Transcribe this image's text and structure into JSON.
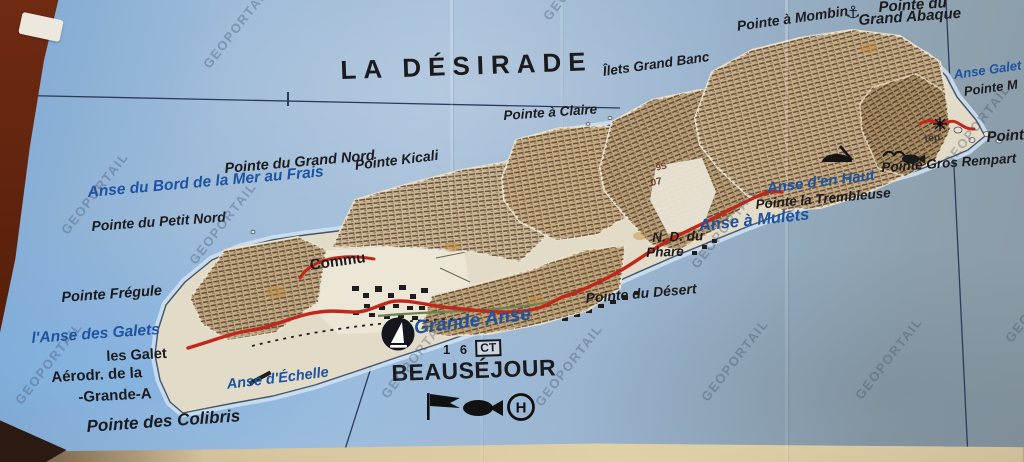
{
  "meta": {
    "kind": "photograph of a paper map with newsprint collage",
    "island": "La Désirade"
  },
  "colors": {
    "sea": "#9db8d4",
    "label_blue": "#1d53a0",
    "label_black": "#1b1b1d",
    "road_red": "#c2271c",
    "track_green": "#6e8352",
    "clipping_tan": "#c6ac85",
    "island_paper": "#e2dbc8",
    "paper_margin": "#d9caa4",
    "photo_border": "#5e2410",
    "watermark": "rgba(62,74,96,0.34)"
  },
  "map": {
    "title": "LA DÉSIRADE",
    "watermark": {
      "text": "GEOPORTAIL"
    },
    "labels": [
      {
        "name": "map-title",
        "text": "LA DÉSIRADE",
        "x": 340,
        "y": 57,
        "size": 26,
        "color": "black",
        "rot": -2,
        "spacing": 7,
        "italic": false
      },
      {
        "name": "label-pointe-a-claire",
        "text": "Pointe à Claire",
        "x": 503,
        "y": 109,
        "size": 13.5,
        "color": "black",
        "rot": -4
      },
      {
        "name": "label-ilets-grand-banc",
        "text": "Îlets Grand Banc",
        "x": 602,
        "y": 65,
        "size": 13.5,
        "color": "black",
        "rot": -8
      },
      {
        "name": "label-pointe-a-mombin",
        "text": "Pointe à Mombin",
        "x": 736,
        "y": 19,
        "size": 14,
        "color": "black",
        "rot": -8
      },
      {
        "name": "label-pointe-du-grand-abaque-line1",
        "text": "Pointe du",
        "x": 878,
        "y": 0,
        "size": 15,
        "color": "black",
        "rot": -4
      },
      {
        "name": "label-pointe-du-grand-abaque-line2",
        "text": "Grand Abaque",
        "x": 858,
        "y": 13,
        "size": 15,
        "color": "black",
        "rot": -4
      },
      {
        "name": "label-anse-galets-east",
        "text": "Anse Galet",
        "x": 953,
        "y": 68,
        "size": 13,
        "color": "blue",
        "rot": -8
      },
      {
        "name": "label-pointe-m",
        "text": "Pointe M",
        "x": 963,
        "y": 85,
        "size": 13,
        "color": "black",
        "rot": -8
      },
      {
        "name": "label-pointe-east",
        "text": "Pointe",
        "x": 986,
        "y": 130,
        "size": 15,
        "color": "black",
        "rot": -4
      },
      {
        "name": "label-pointe-gros-rempart",
        "text": "Pointe Gros Rempart",
        "x": 881,
        "y": 161,
        "size": 13.5,
        "color": "black",
        "rot": -4
      },
      {
        "name": "label-anse-d-en-haut",
        "text": "Anse d'en Haut",
        "x": 766,
        "y": 181,
        "size": 15,
        "color": "blue",
        "rot": -7
      },
      {
        "name": "label-pointe-la-trembleuse",
        "text": "Pointe la Trembleuse",
        "x": 755,
        "y": 198,
        "size": 13.5,
        "color": "black",
        "rot": -5
      },
      {
        "name": "label-anse-a-mulets",
        "text": "Anse à Mulets",
        "x": 698,
        "y": 218,
        "size": 16.5,
        "color": "blue",
        "rot": -6
      },
      {
        "name": "label-nd-du-phare-line1",
        "text": "N. D. du",
        "x": 652,
        "y": 231,
        "size": 13.5,
        "color": "black",
        "rot": -2
      },
      {
        "name": "label-nd-du-phare-line2",
        "text": "Phare",
        "x": 646,
        "y": 246,
        "size": 13.5,
        "color": "black",
        "rot": -2
      },
      {
        "name": "label-pointe-du-desert",
        "text": "Pointe du Désert",
        "x": 585,
        "y": 291,
        "size": 14,
        "color": "black",
        "rot": -5
      },
      {
        "name": "label-grande-anse",
        "text": "Grande Anse",
        "x": 413,
        "y": 319,
        "size": 19,
        "color": "blue",
        "rot": -7
      },
      {
        "name": "label-beausejour",
        "text": "BEAUSÉJOUR",
        "x": 391,
        "y": 361,
        "size": 23,
        "color": "black",
        "rot": -2,
        "italic": false,
        "spacing": 0.5
      },
      {
        "name": "label-spot-height",
        "text": "1 6",
        "x": 443,
        "y": 343,
        "size": 13,
        "color": "black",
        "rot": 0,
        "italic": false,
        "spacing": 3
      },
      {
        "name": "label-ct-box",
        "text": "CT",
        "x": 475,
        "y": 340,
        "size": 12,
        "color": "black",
        "rot": -2,
        "boxed": true
      },
      {
        "name": "label-pointe-kicali",
        "text": "Pointe Kicali",
        "x": 354,
        "y": 158,
        "size": 14,
        "color": "black",
        "rot": -7
      },
      {
        "name": "label-pointe-du-grand-nord",
        "text": "Pointe du Grand Nord",
        "x": 224,
        "y": 162,
        "size": 14.5,
        "color": "black",
        "rot": -5
      },
      {
        "name": "label-anse-du-bord",
        "text": "Anse du Bord de la Mer au Frais",
        "x": 87,
        "y": 185,
        "size": 15.5,
        "color": "blue",
        "rot": -5
      },
      {
        "name": "label-pointe-du-petit-nord",
        "text": "Pointe du Petit Nord",
        "x": 91,
        "y": 219,
        "size": 14,
        "color": "black",
        "rot": -4
      },
      {
        "name": "label-pointe-fregule",
        "text": "Pointe Frégule",
        "x": 61,
        "y": 291,
        "size": 14.5,
        "color": "black",
        "rot": -4
      },
      {
        "name": "label-anse-des-galets",
        "text": "l'Anse des Galets",
        "x": 31,
        "y": 331,
        "size": 15.5,
        "color": "blue",
        "rot": -4
      },
      {
        "name": "label-les-galets",
        "text": "les Galet",
        "x": 106,
        "y": 350,
        "size": 14.5,
        "color": "black",
        "rot": -3,
        "italic": false
      },
      {
        "name": "label-aerodrome",
        "text": "Aérodr. de la",
        "x": 51,
        "y": 370,
        "size": 15,
        "color": "black",
        "rot": -3,
        "italic": false
      },
      {
        "name": "label-grande-anse-aerodrome",
        "text": "-Grande-A",
        "x": 78,
        "y": 390,
        "size": 15,
        "color": "black",
        "rot": -3,
        "italic": false
      },
      {
        "name": "label-anse-d-echelle",
        "text": "Anse d'Échelle",
        "x": 226,
        "y": 378,
        "size": 14.5,
        "color": "blue",
        "rot": -7
      },
      {
        "name": "label-pointe-des-colibris",
        "text": "Pointe des Colibris",
        "x": 86,
        "y": 418,
        "size": 17,
        "color": "black",
        "rot": -4
      },
      {
        "name": "label-commune-fragment",
        "text": "Commu",
        "x": 309,
        "y": 258,
        "size": 15,
        "color": "black",
        "rot": -8,
        "italic": false
      },
      {
        "name": "label-fragment-9s",
        "text": "9S",
        "x": 655,
        "y": 164,
        "size": 9,
        "color": "brown",
        "rot": -14,
        "italic": false
      },
      {
        "name": "label-fragment-07",
        "text": "07",
        "x": 650,
        "y": 179,
        "size": 10,
        "color": "brown",
        "rot": -10,
        "italic": false
      },
      {
        "name": "label-fragment-tep",
        "text": "tép",
        "x": 924,
        "y": 134,
        "size": 10.5,
        "color": "darkgray",
        "rot": -6,
        "italic": false
      }
    ],
    "icons": [
      {
        "name": "anchorage-marina-icon",
        "type": "sail",
        "x": 380,
        "y": 316
      },
      {
        "name": "flag-icon",
        "type": "flag",
        "x": 426,
        "y": 393
      },
      {
        "name": "fish-icon",
        "type": "fish-lg",
        "x": 460,
        "y": 396
      },
      {
        "name": "hospital-icon",
        "type": "circleH",
        "x": 506,
        "y": 392
      },
      {
        "name": "anchor-icon",
        "type": "anchor",
        "x": 843,
        "y": 0
      },
      {
        "name": "shipwreck-icon",
        "type": "wreck",
        "x": 820,
        "y": 144
      },
      {
        "name": "bird-icon",
        "type": "bird",
        "x": 882,
        "y": 146
      },
      {
        "name": "fish-icon-east",
        "type": "fish-sm",
        "x": 900,
        "y": 152
      },
      {
        "name": "lighthouse-icon",
        "type": "star",
        "x": 932,
        "y": 116
      }
    ]
  }
}
